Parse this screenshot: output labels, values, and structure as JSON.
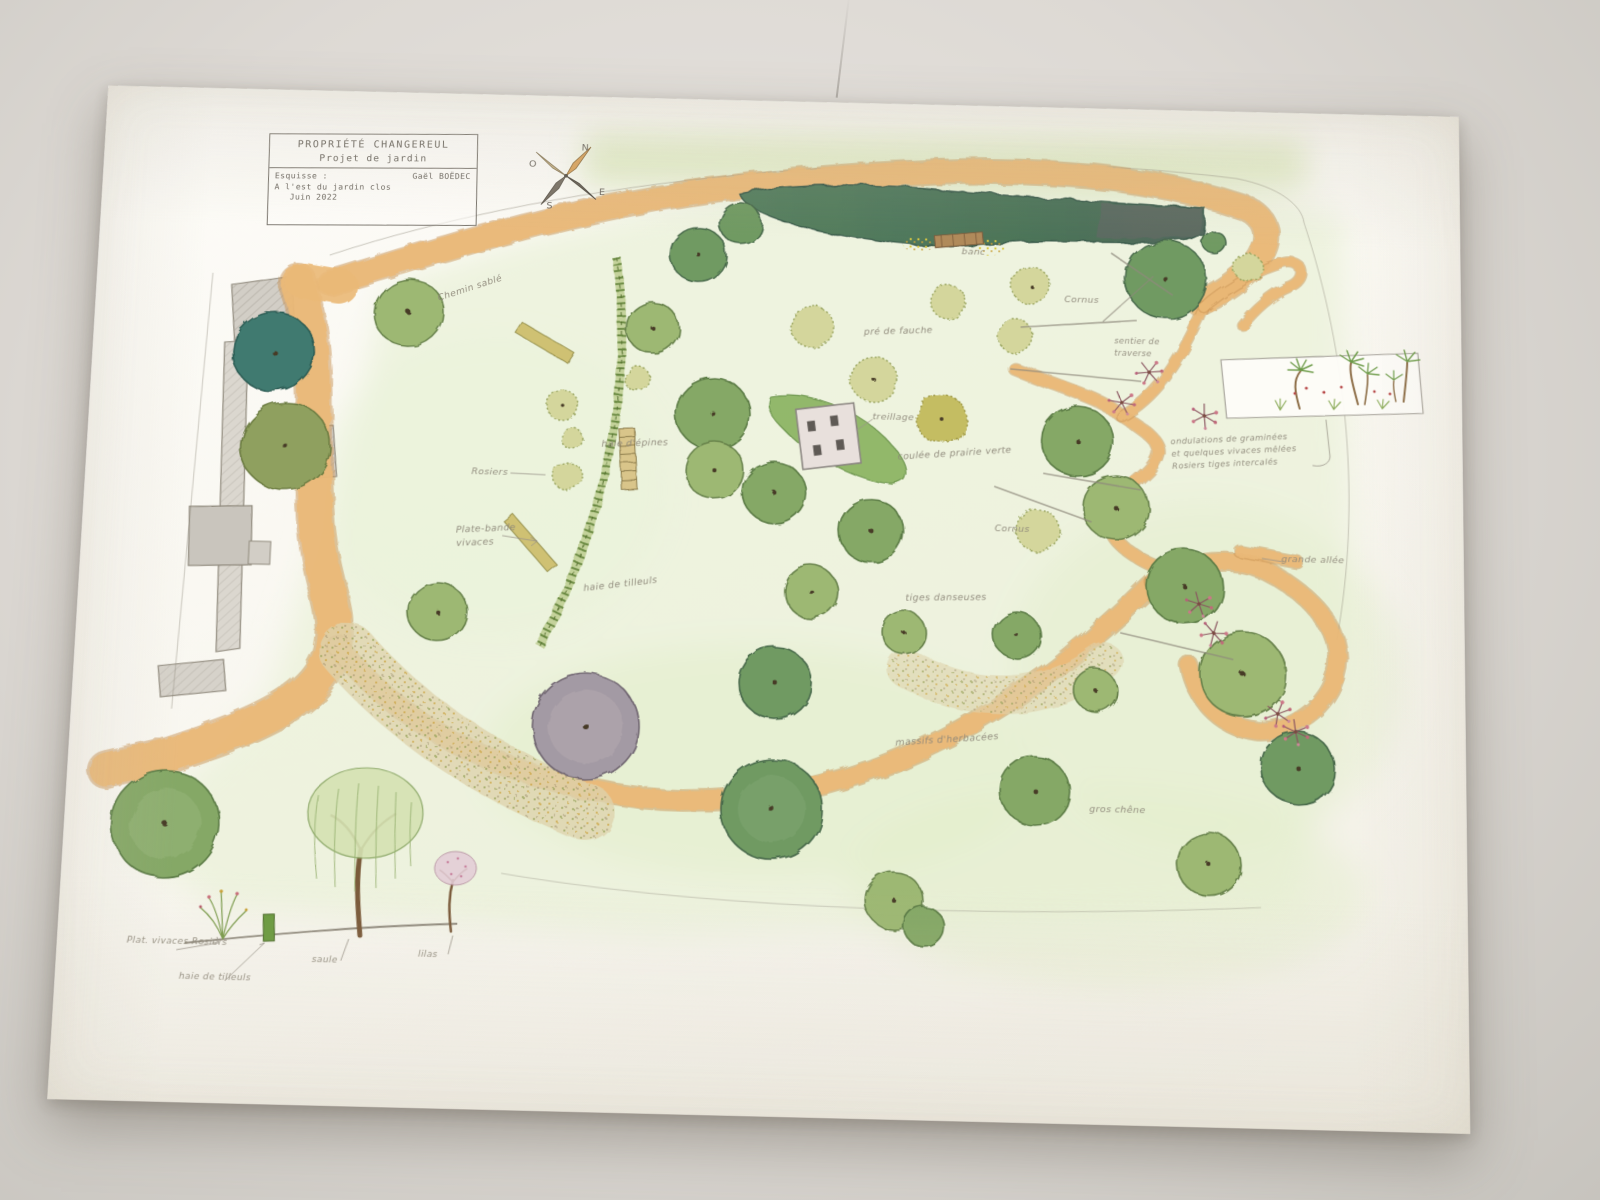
{
  "scene": {
    "description": "Photographie d'un plan de jardin dessiné à la main aux crayons de couleur",
    "background_color": "#ddd9d4",
    "paper_color": "#fcfbf6"
  },
  "title_block": {
    "property": "PROPRIÉTÉ  CHANGEREUL",
    "project": "Projet  de  jardin",
    "sketch_label": "Esquisse :",
    "author": "Gaël BOËDEC",
    "location": "A l'est du jardin clos",
    "date": "Juin 2022"
  },
  "compass": {
    "north": "N",
    "west": "O",
    "east": "E",
    "south": "S"
  },
  "annotations": [
    {
      "id": "chemin-sable",
      "text": "Chemin sablé"
    },
    {
      "id": "rosiers",
      "text": "Rosiers"
    },
    {
      "id": "haie-epines",
      "text": "haie d'épines"
    },
    {
      "id": "plate-bande-vivaces",
      "text": "Plate-bande\nvivaces"
    },
    {
      "id": "haie-tilleuls",
      "text": "haie de tilleuls"
    },
    {
      "id": "pre-de-fauche",
      "text": "pré de fauche"
    },
    {
      "id": "treillage",
      "text": "treillage"
    },
    {
      "id": "coulee-prairie",
      "text": "coulée de prairie verte"
    },
    {
      "id": "banc",
      "text": "banc"
    },
    {
      "id": "cornus-haut",
      "text": "Cornus"
    },
    {
      "id": "cornus-bas",
      "text": "Cornus"
    },
    {
      "id": "sentier",
      "text": "sentier de\ntraverse"
    },
    {
      "id": "ondulations",
      "text": "ondulations de graminées\net quelques vivaces mêlées\nRosiers tiges intercalés"
    },
    {
      "id": "tiges-danseuses",
      "text": "tiges danseuses"
    },
    {
      "id": "massifs-herbacees",
      "text": "massifs d'herbacées"
    },
    {
      "id": "gros-chene",
      "text": "gros chêne"
    },
    {
      "id": "grande-allee",
      "text": "grande allée"
    }
  ],
  "legend": {
    "items": [
      {
        "id": "plat-vivaces",
        "label": "Plat. vivaces Rosiers"
      },
      {
        "id": "haie-tilleuls-legende",
        "label": "haie de tilleuls"
      },
      {
        "id": "saule",
        "label": "saule"
      },
      {
        "id": "lilas",
        "label": "lilas"
      }
    ]
  },
  "colors": {
    "path_sand": "#eaba77",
    "hedge_dark": "#4f7a5e",
    "tree_green": "#8fae6b",
    "tree_mauve": "#a39aa4",
    "lawn_green": "#86b05c",
    "pencil_gray": "#8d8779"
  }
}
